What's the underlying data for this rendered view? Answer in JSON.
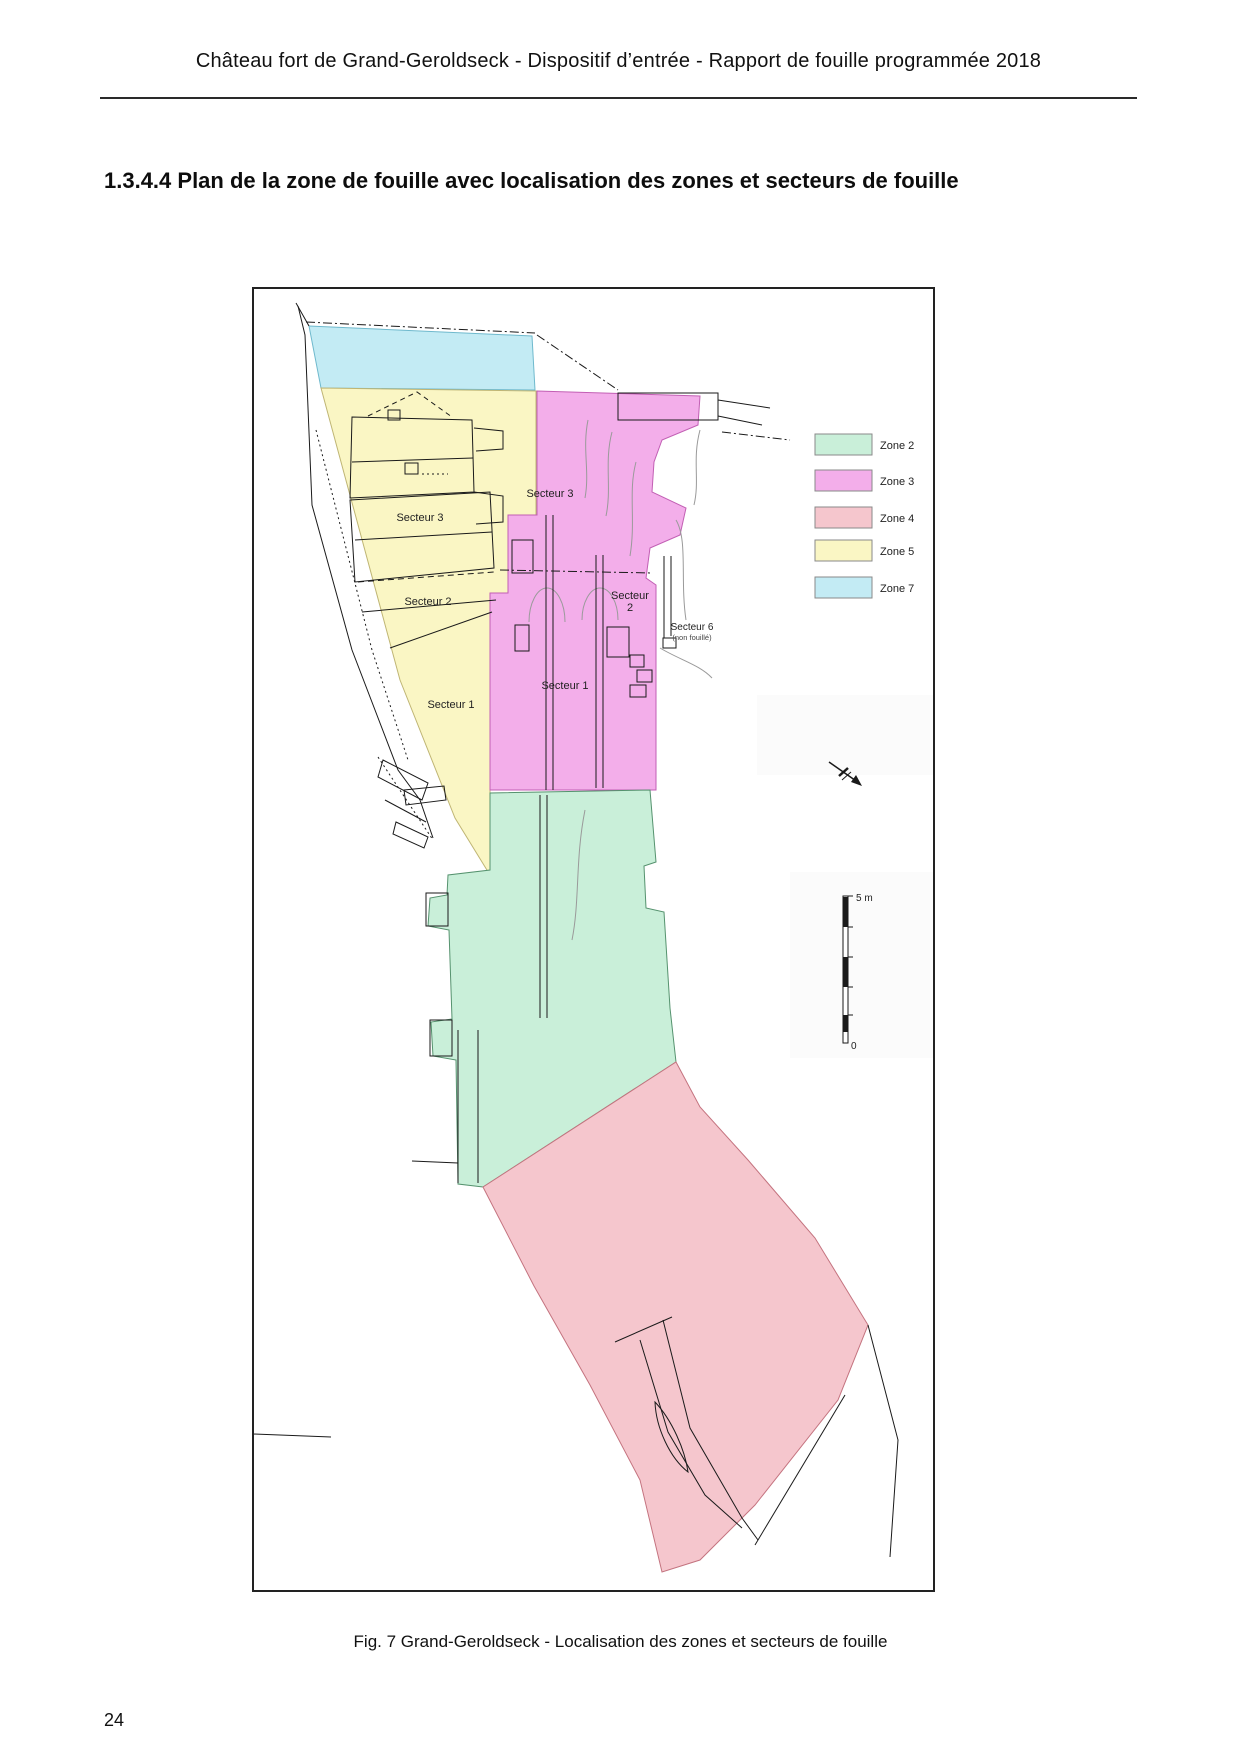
{
  "header": {
    "title": "Château fort de Grand-Geroldseck - Dispositif d’entrée - Rapport de fouille programmée 2018"
  },
  "section": {
    "heading": "1.3.4.4 Plan de la zone de fouille avec localisation des zones et secteurs de fouille"
  },
  "figure": {
    "caption": "Fig. 7 Grand-Geroldseck - Localisation des zones et secteurs de fouille",
    "zones": {
      "zone2": {
        "label": "Zone 2",
        "color": "#c9efd9"
      },
      "zone3": {
        "label": "Zone 3",
        "color": "#f3aeea"
      },
      "zone4": {
        "label": "Zone 4",
        "color": "#f5c6cd"
      },
      "zone5": {
        "label": "Zone 5",
        "color": "#faf6c4"
      },
      "zone7": {
        "label": "Zone 7",
        "color": "#c3ebf4"
      }
    },
    "sector_labels": {
      "zone5_secteur3": "Secteur 3",
      "zone5_secteur2": "Secteur 2",
      "zone5_secteur1": "Secteur 1",
      "zone3_secteur3": "Secteur 3",
      "zone3_secteur2_line1": "Secteur",
      "zone3_secteur2_line2": "2",
      "zone3_secteur1": "Secteur 1",
      "secteur6_line1": "Secteur 6",
      "secteur6_line2": "(non fouillé)"
    },
    "scale_bar": {
      "top_label": "5 m",
      "bottom_label": "0"
    }
  },
  "footer": {
    "page_number": "24"
  }
}
